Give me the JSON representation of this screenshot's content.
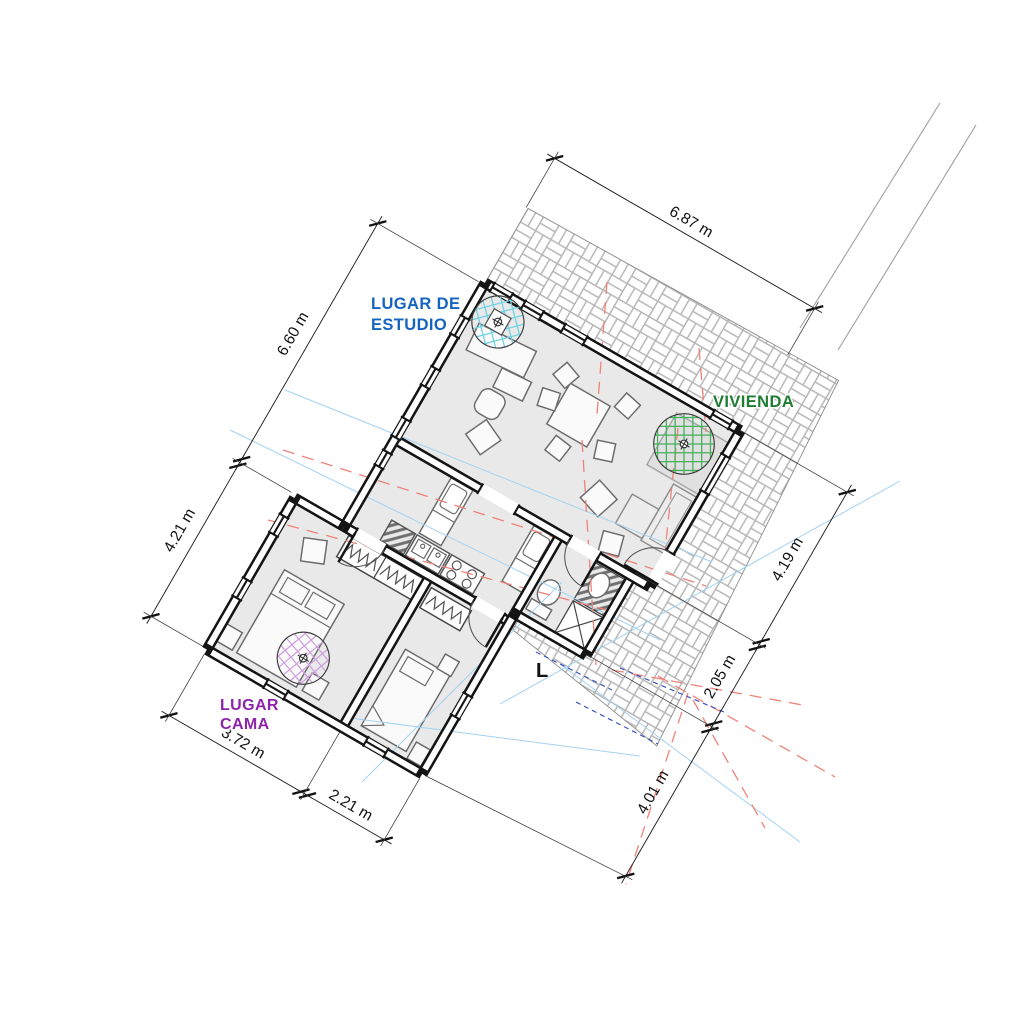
{
  "labels": {
    "study": {
      "line1": "LUGAR DE",
      "line2": "ESTUDIO",
      "color": "#1565c0"
    },
    "vivienda": {
      "text": "VIVIENDA",
      "color": "#1e7d32"
    },
    "cama": {
      "line1": "LUGAR",
      "line2": "CAMA",
      "color": "#8e24aa"
    },
    "l_mark": {
      "text": "L",
      "color": "#111111"
    }
  },
  "dimensions": [
    {
      "label": "6.87 m",
      "axis": "x",
      "offset": -3.4,
      "from": -0.05,
      "to": 7.1,
      "ticks": [
        "s",
        "s"
      ],
      "ext": [
        [
          -0.05,
          -3.58,
          -0.05,
          -2.05
        ],
        [
          7.1,
          -3.58,
          7.1,
          -2.12
        ]
      ]
    },
    {
      "label": "6.60 m",
      "axis": "y",
      "offset": -2.92,
      "from": 0.05,
      "to": 6.62,
      "ticks": [
        "s",
        "d"
      ],
      "ext": [
        [
          -3.12,
          0.05,
          -0.15,
          0.05
        ],
        [
          -3.12,
          6.62,
          -1.5,
          6.62
        ]
      ]
    },
    {
      "label": "4.21 m",
      "axis": "y",
      "offset": -2.92,
      "from": 6.62,
      "to": 10.85,
      "ticks": [
        "n",
        "s"
      ],
      "ext": [
        [
          -3.12,
          10.85,
          -1.5,
          10.85
        ]
      ]
    },
    {
      "label": "3.72 m",
      "axis": "x",
      "offset": 12.68,
      "from": -1.37,
      "to": 2.35,
      "ticks": [
        "s",
        "d"
      ],
      "ext": [
        [
          -1.37,
          12.85,
          -1.37,
          11.0
        ],
        [
          2.35,
          12.85,
          2.35,
          11.0
        ]
      ]
    },
    {
      "label": "2.21 m",
      "axis": "x",
      "offset": 12.68,
      "from": 2.35,
      "to": 4.55,
      "ticks": [
        "n",
        "s"
      ],
      "ext": [
        [
          4.55,
          12.85,
          4.55,
          11.0
        ]
      ]
    },
    {
      "label": "4.19 m",
      "axis": "y",
      "offset": 9.96,
      "from": 0.0,
      "to": 4.19,
      "ticks": [
        "s",
        "d"
      ],
      "ext": [
        [
          10.14,
          0.0,
          7.05,
          0.0
        ],
        [
          10.14,
          4.19,
          6.55,
          4.19
        ]
      ]
    },
    {
      "label": "2.05 m",
      "axis": "y",
      "offset": 9.96,
      "from": 4.19,
      "to": 6.45,
      "ticks": [
        "n",
        "d"
      ],
      "ext": [
        [
          10.14,
          6.45,
          6.55,
          6.45
        ]
      ]
    },
    {
      "label": "4.01 m",
      "axis": "y",
      "offset": 9.96,
      "from": 6.45,
      "to": 10.55,
      "ticks": [
        "n",
        "s"
      ],
      "ext": [
        [
          10.14,
          10.55,
          4.62,
          10.87
        ]
      ]
    }
  ],
  "colors": {
    "wall": "#141414",
    "floor": "#e9e9e9",
    "dim": "#1c1c1c",
    "ext": "#3a3a3a",
    "furniture": "#6b6b6b",
    "hatch_outline": "#8f8f8f",
    "contour": "#a3d2f2",
    "setback": "#f0827a",
    "drain": "#3b55c4",
    "site": "#a0a0a0",
    "tree_grid": "#46b05c",
    "study_grid": "#6fd2e4",
    "bed_grid": "#cfa0df"
  }
}
